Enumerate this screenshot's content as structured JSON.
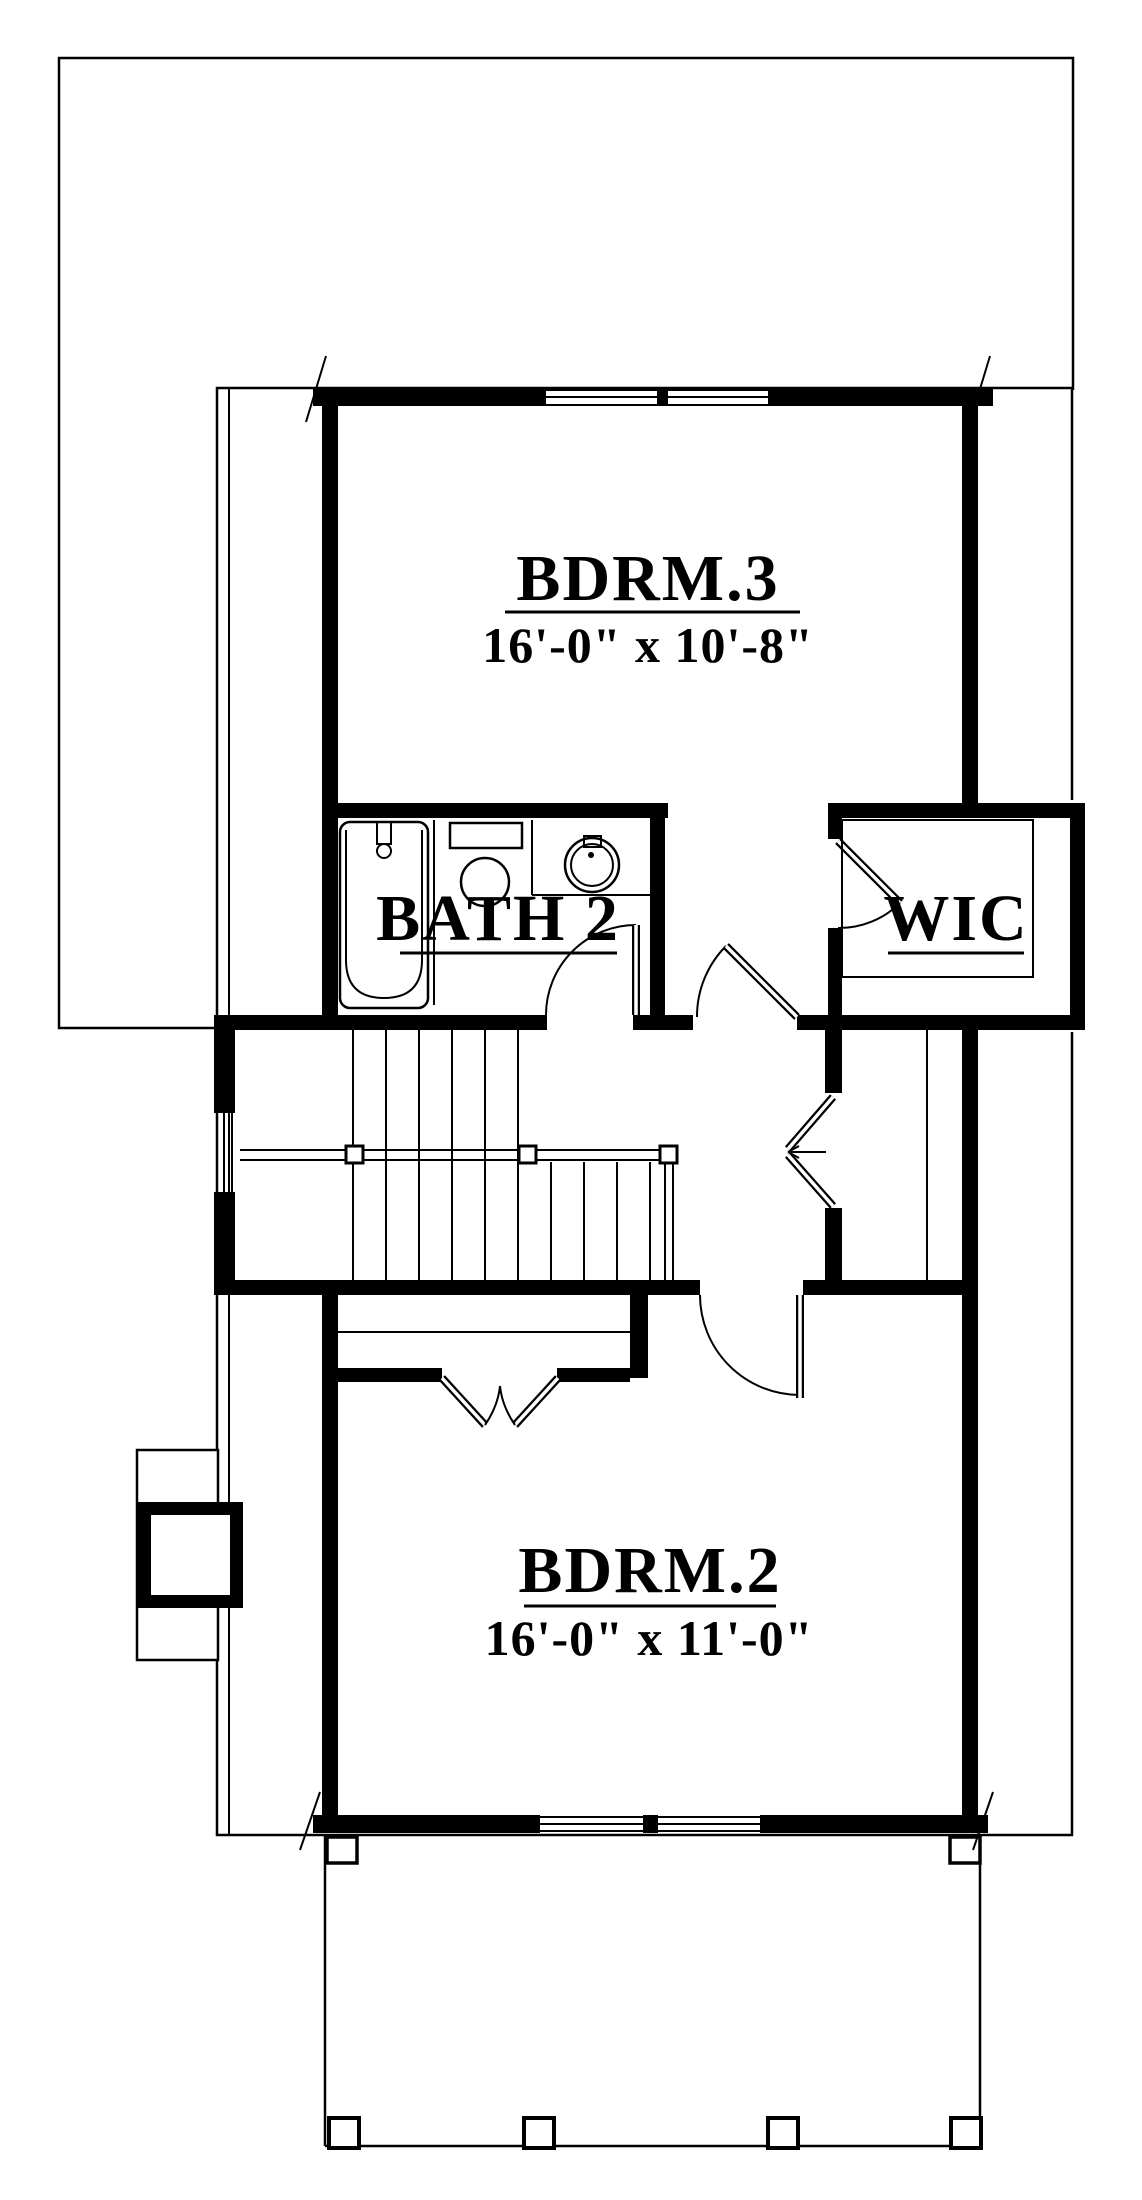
{
  "colors": {
    "line": "#000000",
    "background": "#ffffff"
  },
  "rooms": {
    "bdrm3": {
      "label": "BDRM.3",
      "dims": "16'-0\" x 10'-8\""
    },
    "bath2": {
      "label": "BATH 2"
    },
    "wic": {
      "label": "WIC"
    },
    "bdrm2": {
      "label": "BDRM.2",
      "dims": "16'-0\" x 11'-0\""
    }
  }
}
